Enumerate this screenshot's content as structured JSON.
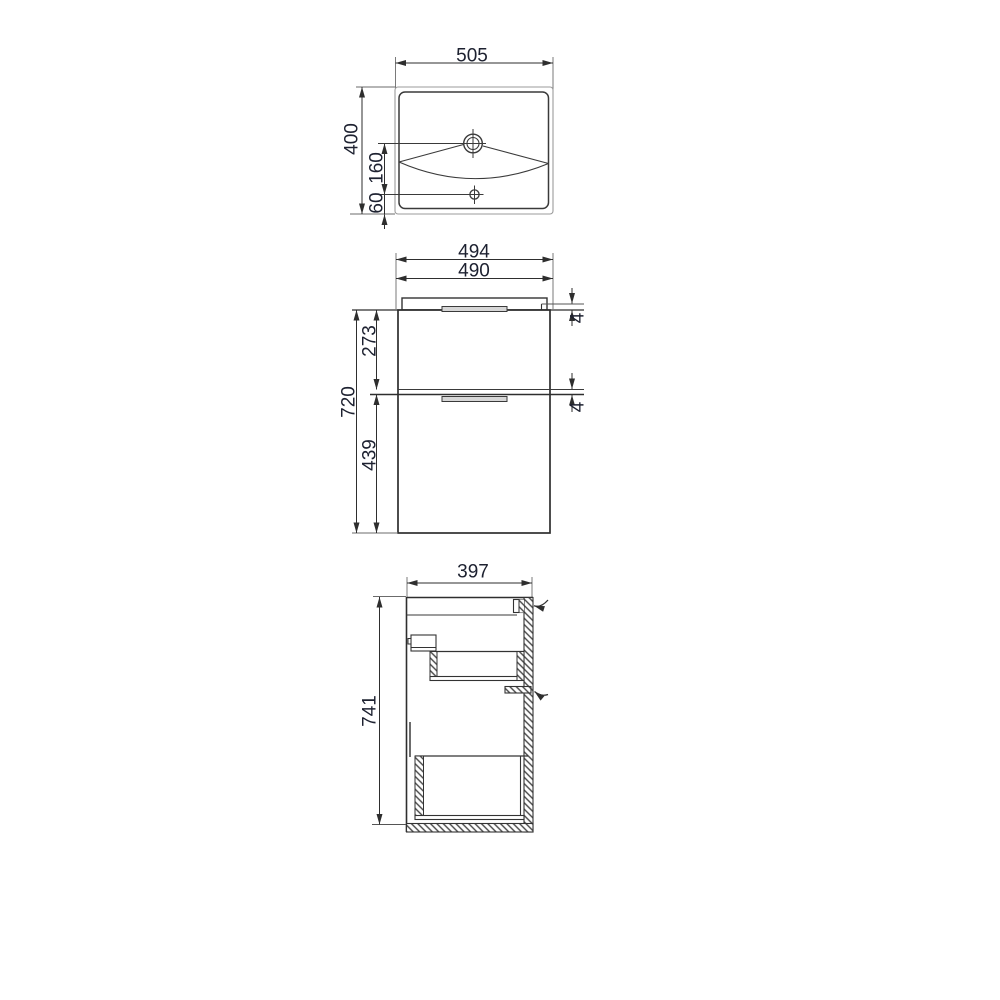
{
  "views": {
    "top": {
      "width": "505",
      "height": "400",
      "tap_to_drain": "160",
      "drain_to_edge": "60"
    },
    "front": {
      "top_panel_width": "494",
      "cabinet_width": "490",
      "total_height": "720",
      "upper_drawer_height": "273",
      "lower_drawer_height": "439",
      "upper_gap": "4",
      "lower_gap": "4"
    },
    "side": {
      "depth": "397",
      "height": "741"
    }
  }
}
